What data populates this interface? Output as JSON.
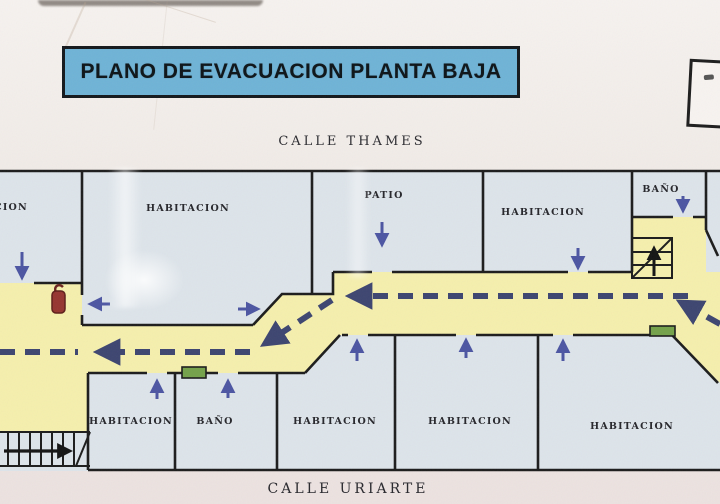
{
  "title": "PLANO DE EVACUACION PLANTA BAJA",
  "streets": {
    "top": "CALLE THAMES",
    "bottom": "CALLE URIARTE"
  },
  "rooms": {
    "top": [
      {
        "id": "top-left-habitacion",
        "label": "HABITACION"
      },
      {
        "id": "top-habitacion-2",
        "label": "HABITACION"
      },
      {
        "id": "patio",
        "label": "PATIO"
      },
      {
        "id": "top-habitacion-4",
        "label": "HABITACION"
      },
      {
        "id": "top-bano",
        "label": "BAÑO"
      }
    ],
    "bottom": [
      {
        "id": "bottom-habitacion-1",
        "label": "HABITACION"
      },
      {
        "id": "bottom-bano",
        "label": "BAÑO"
      },
      {
        "id": "bottom-habitacion-3",
        "label": "HABITACION"
      },
      {
        "id": "bottom-habitacion-4",
        "label": "HABITACION"
      },
      {
        "id": "bottom-habitacion-5",
        "label": "HABITACION"
      }
    ]
  },
  "icons": {
    "extinguisher": "fire-extinguisher-icon",
    "stairs_top_right": "stairs-icon",
    "stairs_bottom_left": "stairs-icon",
    "exit_markers": "green-exit-door-marker",
    "route": "dashed-evacuation-route-arrows"
  },
  "colors": {
    "c-title-bg": "#6fb3d6",
    "c-room": "#dde4ea",
    "c-corridor": "#f5efad",
    "c-wall": "#1c1c1c",
    "c-route": "#3d4570",
    "c-arrow": "#4c55a2",
    "c-exit-green": "#74a24a",
    "c-extinguisher": "#963530",
    "c-photo-bg": "#ece4e1"
  }
}
